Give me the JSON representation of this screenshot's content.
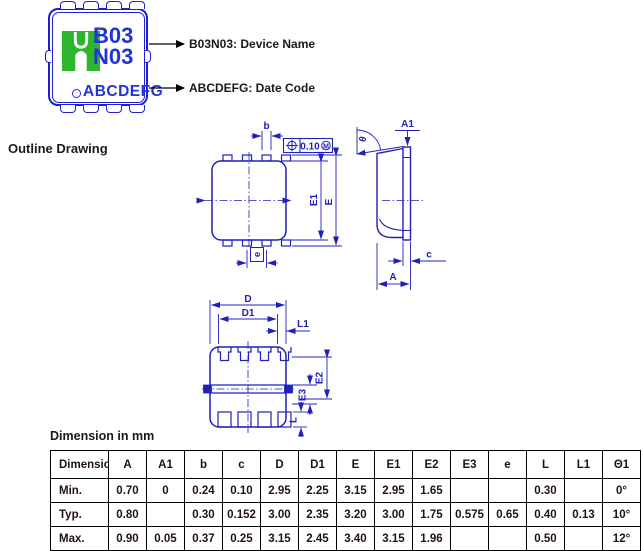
{
  "colors": {
    "drawing_blue": "#2020bb",
    "marking_blue": "#2233d8",
    "logo_green": "#2db52d",
    "text_ink": "#1a1a1a"
  },
  "marking": {
    "line1": "B03",
    "line2": "N03",
    "date_code": "ABCDEFG"
  },
  "callouts": {
    "device": "B03N03: Device Name",
    "date": "ABCDEFG: Date Code"
  },
  "outline": {
    "title": "Outline Drawing",
    "tolerance": "0.10",
    "mmc": "M",
    "labels": {
      "b": "b",
      "e": "e",
      "E": "E",
      "E1": "E1",
      "A": "A",
      "A1": "A1",
      "c": "c",
      "theta": "θ",
      "D": "D",
      "D1": "D1",
      "L1": "L1",
      "E2": "E2",
      "E3": "E3",
      "L": "L"
    }
  },
  "table": {
    "caption": "Dimension in mm",
    "headers": [
      "Dimension",
      "A",
      "A1",
      "b",
      "c",
      "D",
      "D1",
      "E",
      "E1",
      "E2",
      "E3",
      "e",
      "L",
      "L1",
      "Θ1"
    ],
    "rows": [
      {
        "label": "Min.",
        "values": [
          "0.70",
          "0",
          "0.24",
          "0.10",
          "2.95",
          "2.25",
          "3.15",
          "2.95",
          "1.65",
          "",
          "",
          "0.30",
          "",
          "0°"
        ]
      },
      {
        "label": "Typ.",
        "values": [
          "0.80",
          "",
          "0.30",
          "0.152",
          "3.00",
          "2.35",
          "3.20",
          "3.00",
          "1.75",
          "0.575",
          "0.65",
          "0.40",
          "0.13",
          "10°"
        ]
      },
      {
        "label": "Max.",
        "values": [
          "0.90",
          "0.05",
          "0.37",
          "0.25",
          "3.15",
          "2.45",
          "3.40",
          "3.15",
          "1.96",
          "",
          "",
          "0.50",
          "",
          "12°"
        ]
      }
    ]
  }
}
